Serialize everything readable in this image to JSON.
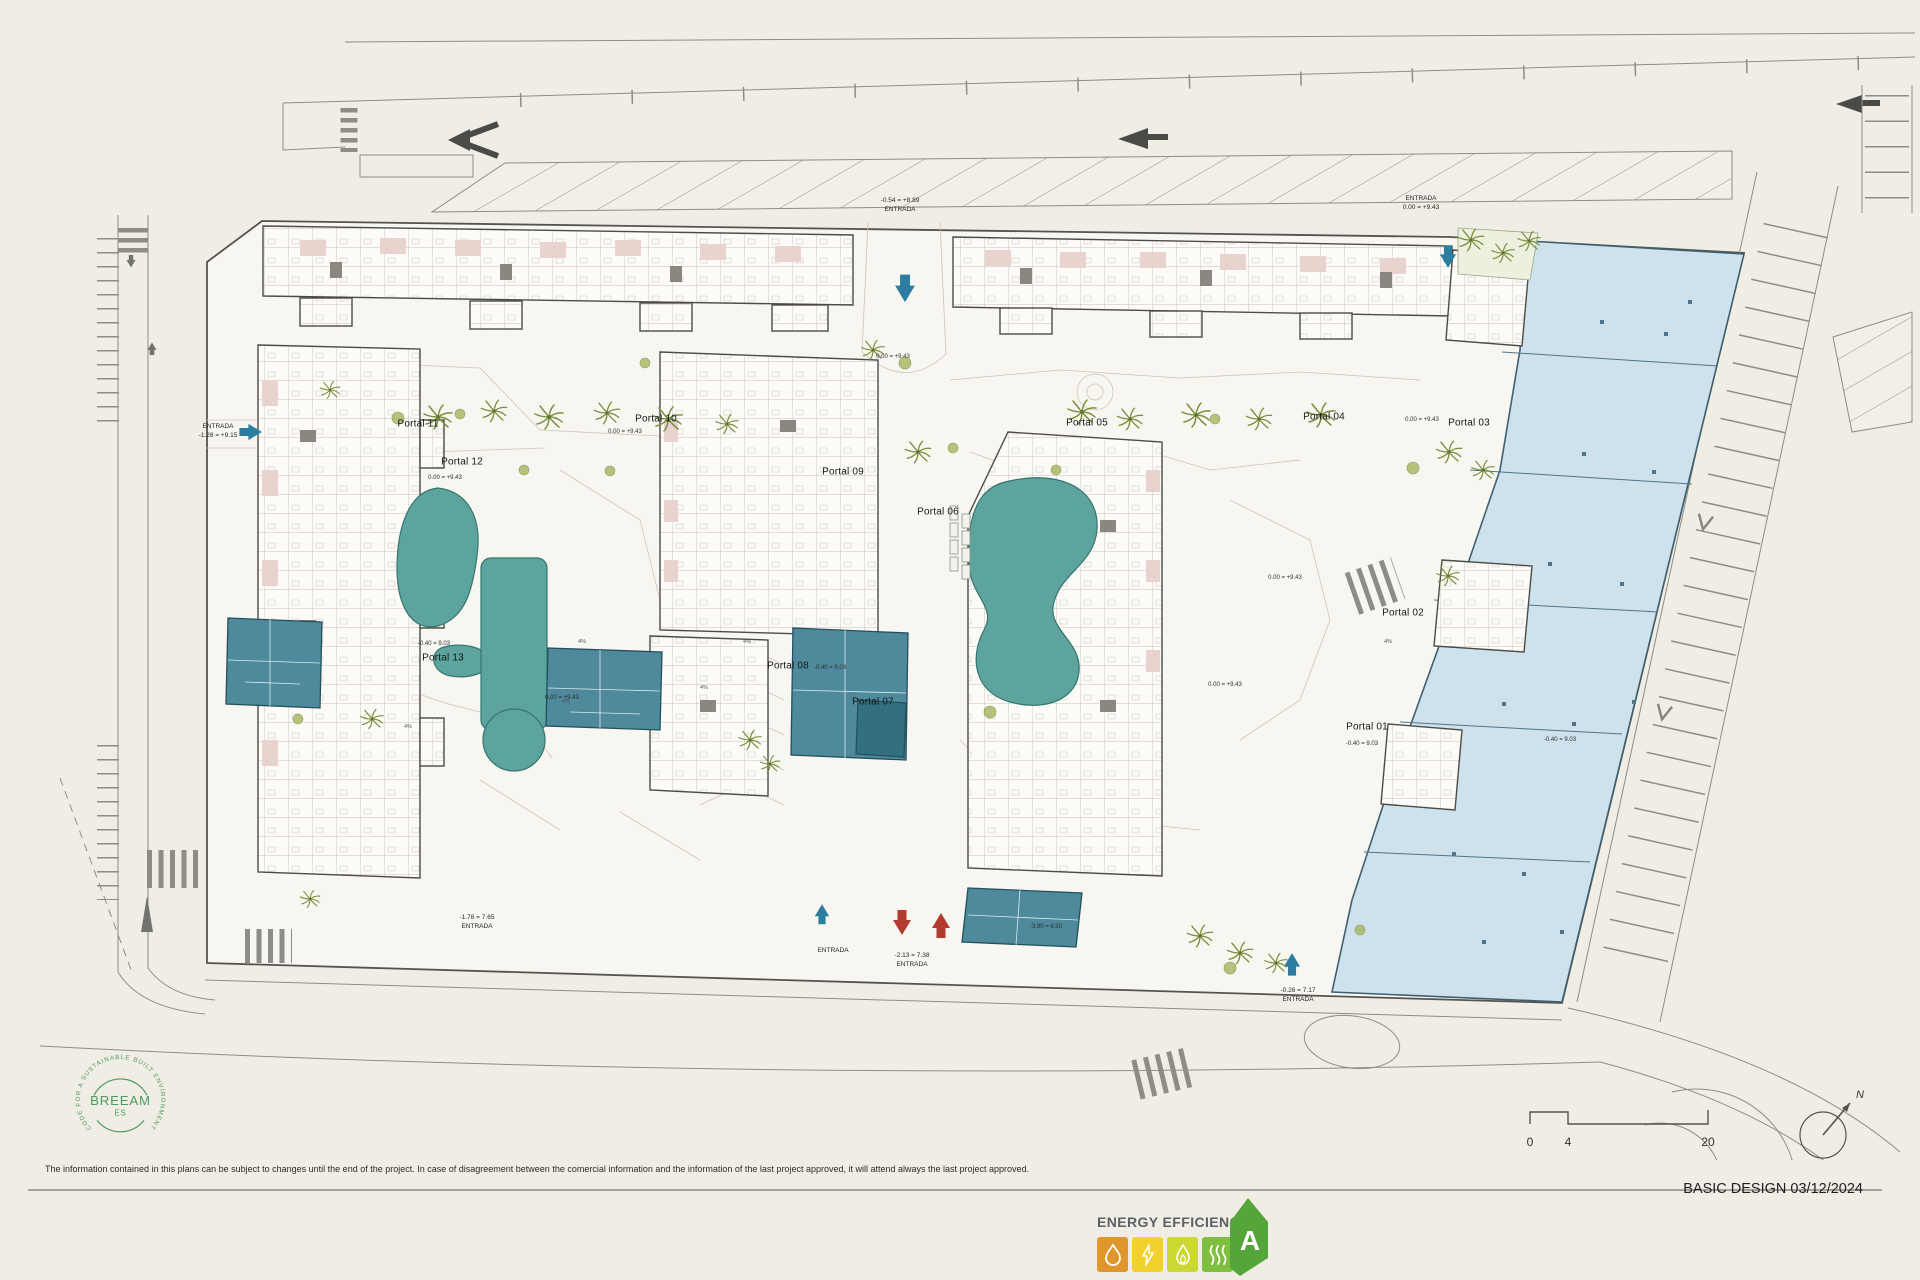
{
  "meta": {
    "phase": "BASIC DESIGN 03/12/2024",
    "disclaimer": "The information contained in this plans can be subject to changes until the end of the project. In case of disagreement between the comercial information and the information of the last project approved, it will attend always the last project approved."
  },
  "colors": {
    "paper": "#f0ede5",
    "site": "#f8f6f0",
    "pool": "#5ca49d",
    "commercial_block": "#4e8a9c",
    "retail_area": "#cee2ed",
    "vegetation": "#7a8f3e",
    "breeam_green": "#4c9960",
    "energy_orange": "#e0952d",
    "energy_yellow": "#f2d12e",
    "energy_lime": "#cbd733",
    "energy_green": "#7fbf3f",
    "rating_green": "#55a63a",
    "arrow_blue": "#2c7da0",
    "arrow_red": "#b23a2e"
  },
  "plan": {
    "portals": [
      {
        "label": "Portal 11",
        "x": 418,
        "y": 424
      },
      {
        "label": "Portal 10",
        "x": 656,
        "y": 419
      },
      {
        "label": "Portal 12",
        "x": 462,
        "y": 462
      },
      {
        "label": "Portal 13",
        "x": 443,
        "y": 658
      },
      {
        "label": "Portal 09",
        "x": 843,
        "y": 472
      },
      {
        "label": "Portal 08",
        "x": 788,
        "y": 666
      },
      {
        "label": "Portal 07",
        "x": 873,
        "y": 702
      },
      {
        "label": "Portal 06",
        "x": 938,
        "y": 512
      },
      {
        "label": "Portal 05",
        "x": 1087,
        "y": 423
      },
      {
        "label": "Portal 04",
        "x": 1324,
        "y": 417
      },
      {
        "label": "Portal 03",
        "x": 1469,
        "y": 423
      },
      {
        "label": "Portal 02",
        "x": 1403,
        "y": 613
      },
      {
        "label": "Portal 01",
        "x": 1367,
        "y": 727
      }
    ],
    "entrances": [
      {
        "line1": "-0.54 = +8.89",
        "line2": "ENTRADA",
        "x": 900,
        "y": 196
      },
      {
        "line1": "ENTRADA",
        "line2": "0.00 = +9.43",
        "x": 1421,
        "y": 194
      },
      {
        "line1": "ENTRADA",
        "line2": "-1.28 = +9.15",
        "x": 218,
        "y": 422
      },
      {
        "line1": "-1.78 = 7.65",
        "line2": "ENTRADA",
        "x": 477,
        "y": 913
      },
      {
        "line1": "ENTRADA",
        "line2": "",
        "x": 833,
        "y": 946
      },
      {
        "line1": "-2.13 = 7.38",
        "line2": "ENTRADA",
        "x": 912,
        "y": 951
      },
      {
        "line1": "-0.26 = 7.17",
        "line2": "ENTRADA",
        "x": 1298,
        "y": 986
      }
    ],
    "elevations": [
      {
        "text": "0.00 = +9.43",
        "x": 625,
        "y": 432
      },
      {
        "text": "0.00 = +9.43",
        "x": 445,
        "y": 478
      },
      {
        "text": "0.00 = +9.43",
        "x": 1422,
        "y": 420
      },
      {
        "text": "0.00 = +9.43",
        "x": 893,
        "y": 357
      },
      {
        "text": "0.00 = +9.43",
        "x": 562,
        "y": 698
      },
      {
        "text": "0.00 = +9.43",
        "x": 1285,
        "y": 578
      },
      {
        "text": "0.00 = +9.43",
        "x": 1225,
        "y": 685
      },
      {
        "text": "-0.40 = 9.03",
        "x": 434,
        "y": 644
      },
      {
        "text": "-0.40 = 9.03",
        "x": 830,
        "y": 668
      },
      {
        "text": "-0.40 = 9.03",
        "x": 1362,
        "y": 744
      },
      {
        "text": "-0.40 = 9.03",
        "x": 1560,
        "y": 740
      },
      {
        "text": "-3.90 = 6.50",
        "x": 1046,
        "y": 927
      }
    ],
    "slopes": [
      {
        "text": "4%",
        "x": 582,
        "y": 642
      },
      {
        "text": "4%",
        "x": 566,
        "y": 702
      },
      {
        "text": "4%",
        "x": 408,
        "y": 727
      },
      {
        "text": "4%",
        "x": 1388,
        "y": 642
      },
      {
        "text": "4%",
        "x": 704,
        "y": 688
      },
      {
        "text": "4%",
        "x": 747,
        "y": 642
      }
    ]
  },
  "legend": {
    "breeam": {
      "ring_text": "CODE FOR A SUSTAINABLE BUILT ENVIRONMENT",
      "name": "BREEAM",
      "region": "ES"
    },
    "energy": {
      "title": "ENERGY EFFICIENCY",
      "rating": "A",
      "icons": [
        "water-drop-icon",
        "lightning-icon",
        "flame-icon",
        "heat-waves-icon"
      ]
    },
    "scale": {
      "ticks": [
        "0",
        "4",
        "20"
      ]
    },
    "compass": {
      "label": "N"
    }
  }
}
